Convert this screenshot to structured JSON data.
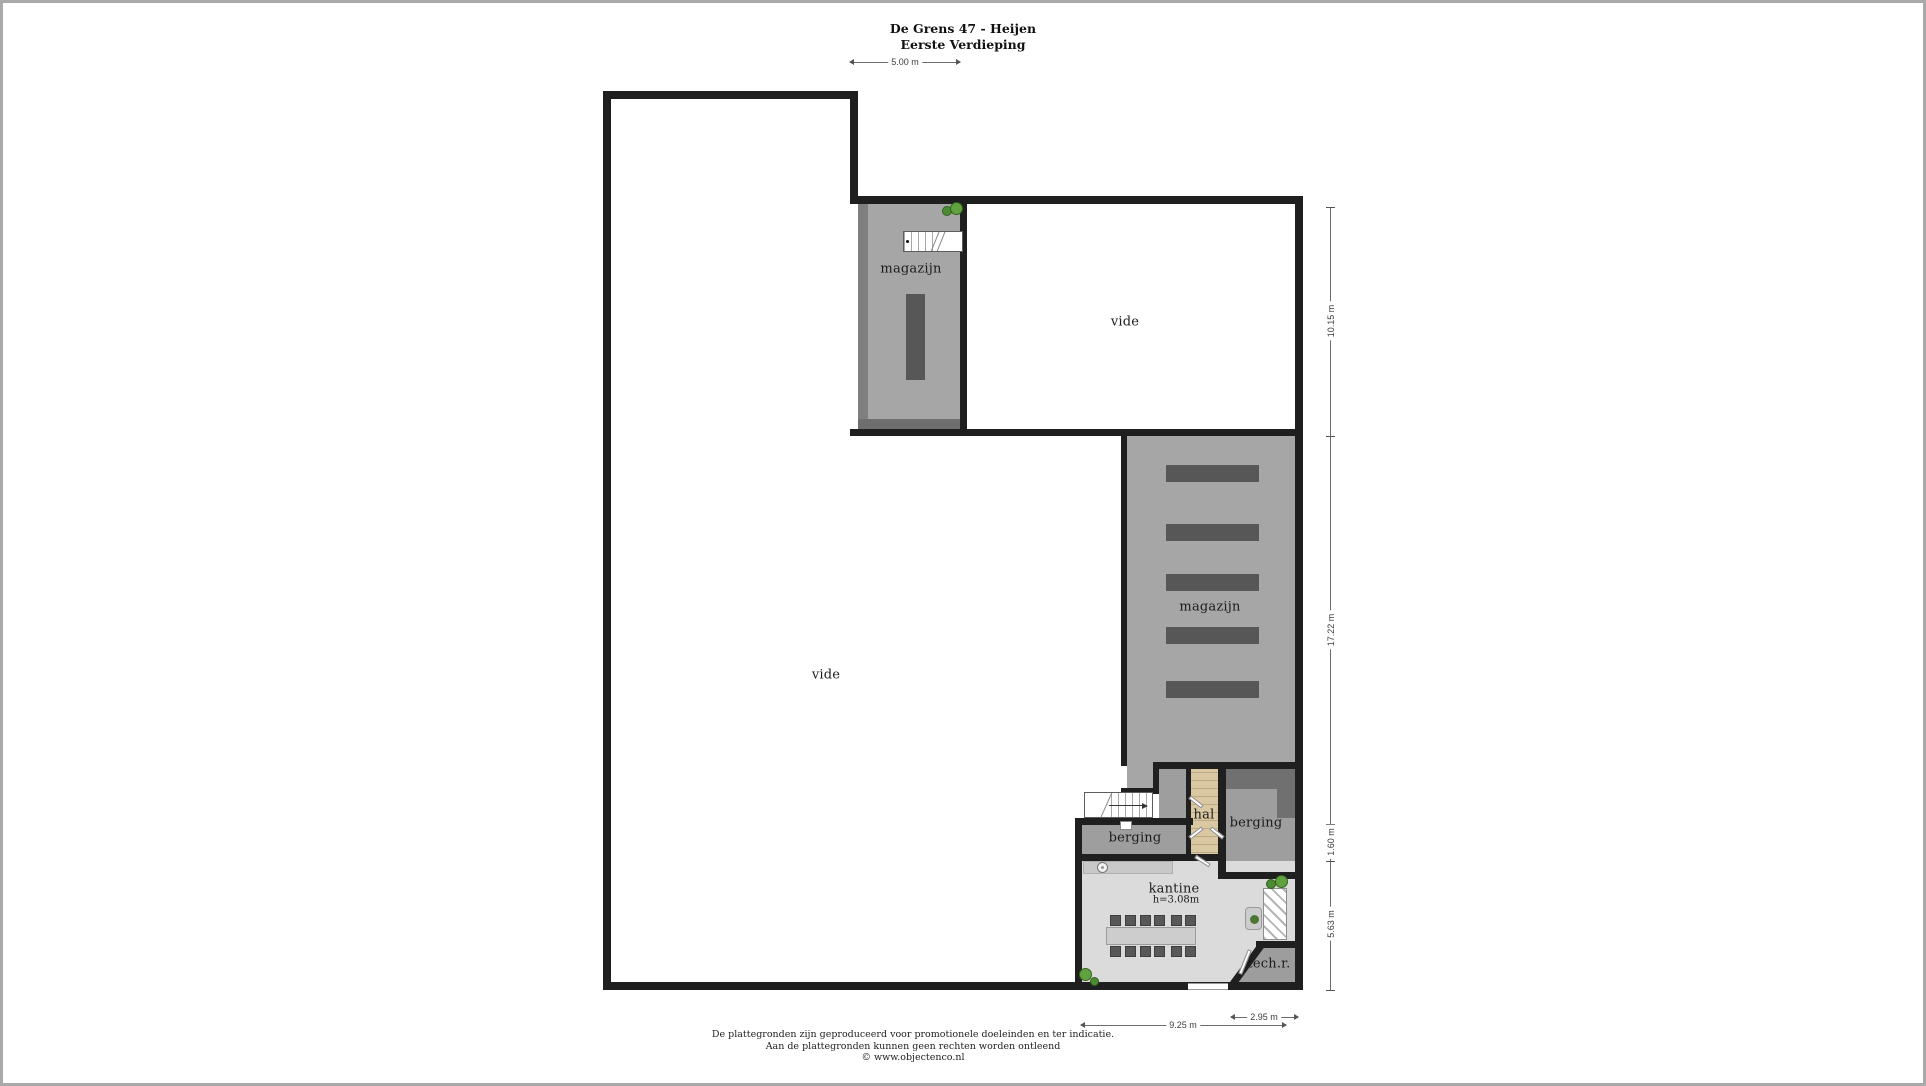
{
  "title": "De Grens 47 - Heijen",
  "subtitle": "Eerste Verdieping",
  "rooms": {
    "magazijn_upper": {
      "label": "magazijn"
    },
    "vide_upper": {
      "label": "vide"
    },
    "vide_main": {
      "label": "vide"
    },
    "magazijn_right": {
      "label": "magazijn"
    },
    "berging_left": {
      "label": "berging"
    },
    "hal": {
      "label": "hal"
    },
    "berging_right": {
      "label": "berging"
    },
    "kantine": {
      "label": "kantine",
      "height_note": "h=3.08m"
    },
    "techroom": {
      "label": "tech.r."
    }
  },
  "dimensions": {
    "top_width": "5.00 m",
    "right_top": "10.15 m",
    "right_middle": "17.22 m",
    "right_lower": "1.60 m",
    "right_bottom": "5.63 m",
    "bottom_kantine": "9.25 m",
    "bottom_techroom": "2.95 m"
  },
  "footer": {
    "line1": "De plattegronden zijn geproduceerd voor promotionele doeleinden en ter indicatie.",
    "line2": "Aan de plattegronden kunnen geen rechten worden ontleend",
    "line3": "© www.objectenco.nl"
  },
  "colors": {
    "wall": "#1f1f1f",
    "storage_gray": "#a6a6a6",
    "room_gray": "#9e9e9e",
    "dark_band": "#707070",
    "rack": "#575757",
    "kantine_floor": "#dbdbdb",
    "hal_wood": "#d9c8a1",
    "plant_green": "#4c8a33",
    "frame": "#a9a9a9"
  },
  "icons": {
    "plant": "plant-icon",
    "sink": "sink-icon",
    "stairs_direction_arrow": "→"
  }
}
